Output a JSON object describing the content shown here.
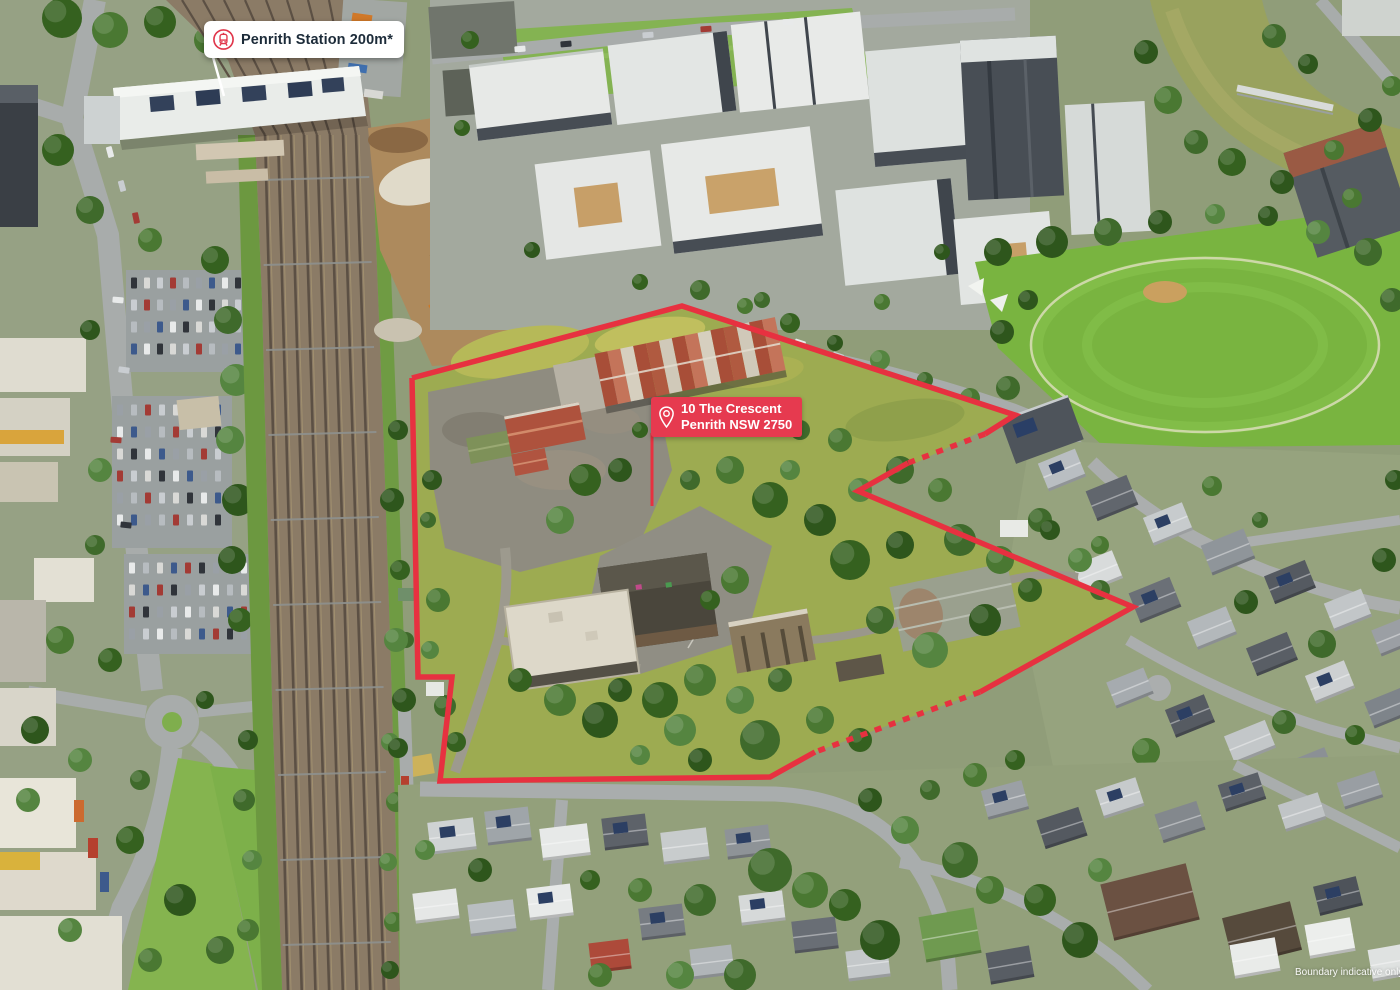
{
  "overlay": {
    "station_badge": {
      "label": "Penrith Station 200m*",
      "icon": "train-icon"
    },
    "site_badge": {
      "address_line1": "10 The Crescent",
      "address_line2": "Penrith NSW 2750",
      "icon": "location-pin-icon"
    },
    "disclaimer": "Boundary indicative only"
  },
  "colors": {
    "accent_red": "#e63a4f",
    "boundary_red": "#e73140",
    "badge_text": "#1c2b39"
  }
}
